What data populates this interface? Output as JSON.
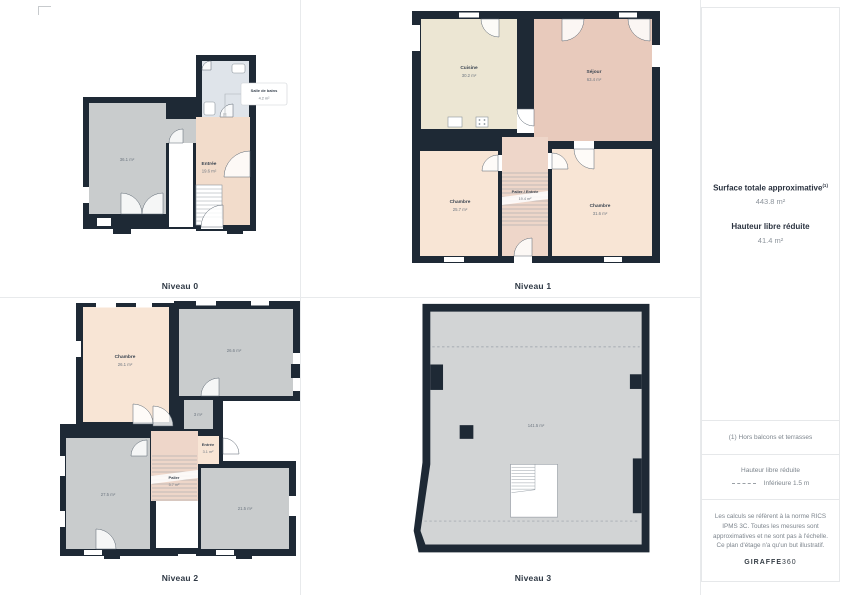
{
  "colors": {
    "wall": "#1e2935",
    "room_gray": "#c9cccd",
    "room_gray_light": "#d2d4d5",
    "room_cream": "#ece6d3",
    "room_pink": "#e8cabc",
    "room_peach": "#f8e5d5",
    "room_peach_dark": "#f2dccb",
    "room_dusty": "#eed6c9",
    "room_bath": "#dfe4ea"
  },
  "levels": [
    {
      "title": "Niveau 0",
      "rooms": [
        {
          "name": "Salle de bains",
          "area": "4.2 m²"
        },
        {
          "name": "",
          "area": "36.1 m²"
        },
        {
          "name": "Entrée",
          "area": "19.6 m²"
        }
      ]
    },
    {
      "title": "Niveau 1",
      "rooms": [
        {
          "name": "Cuisine",
          "area": "30.2 m²"
        },
        {
          "name": "Séjour",
          "area": "63.4 m²"
        },
        {
          "name": "Chambre",
          "area": "25.7 m²"
        },
        {
          "name": "Palier / Entrée",
          "area": "19.4 m²"
        },
        {
          "name": "Chambre",
          "area": "31.6 m²"
        }
      ]
    },
    {
      "title": "Niveau 2",
      "rooms": [
        {
          "name": "Chambre",
          "area": "26.1 m²"
        },
        {
          "name": "",
          "area": "26.6 m²"
        },
        {
          "name": "",
          "area": "3 m²"
        },
        {
          "name": "Entrée",
          "area": "3.1 m²"
        },
        {
          "name": "Palier",
          "area": "5.7 m²"
        },
        {
          "name": "",
          "area": "27.5 m²"
        },
        {
          "name": "",
          "area": "21.5 m²"
        }
      ]
    },
    {
      "title": "Niveau 3",
      "rooms": [
        {
          "name": "",
          "area": "141.5 m²"
        }
      ]
    }
  ],
  "sidebar": {
    "surface_title": "Surface totale approximative",
    "surface_footnote_ref": "(1)",
    "surface_value": "443.8 m²",
    "height_title": "Hauteur libre réduite",
    "height_value": "41.4 m²",
    "footnote": "(1) Hors balcons et terrasses",
    "legend_title": "Hauteur libre réduite",
    "legend_item": "Inférieure 1.5 m",
    "disclaimer": "Les calculs se réfèrent à la norme RICS IPMS 3C. Toutes les mesures sont approximatives et ne sont pas à l'échelle. Ce plan d'étage n'a qu'un but illustratif.",
    "brand_bold": "GIRAFFE",
    "brand_light": "360"
  }
}
